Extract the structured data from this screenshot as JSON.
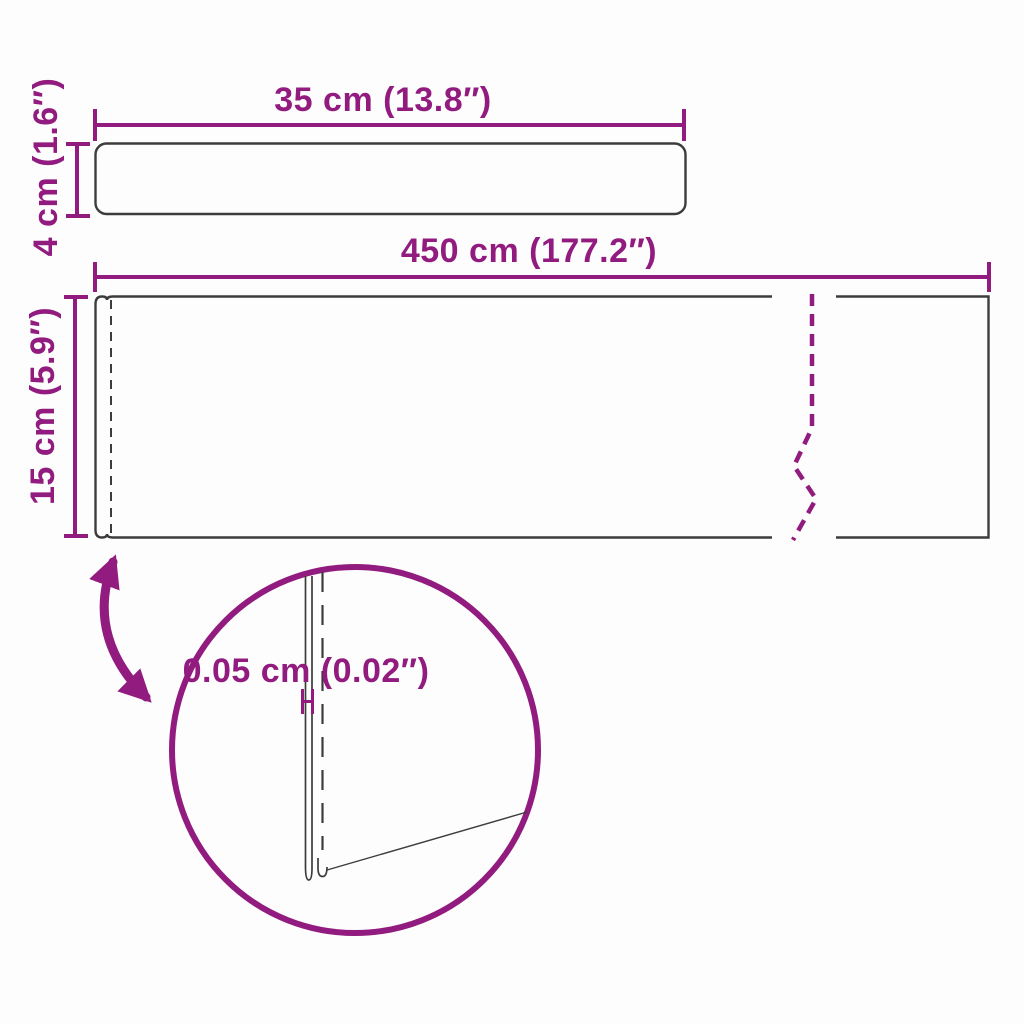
{
  "image_type": "product-dimension-diagram",
  "colors": {
    "accent": "#911B7E",
    "outline": "#3C3C3C",
    "background": "#FDFDFD"
  },
  "panels": {
    "small": {
      "width_label": "35 cm (13.8″)",
      "height_label": "4 cm (1.6″)"
    },
    "large": {
      "width_label": "450 cm (177.2″)",
      "height_label": "15 cm (5.9″)"
    }
  },
  "detail_view": {
    "thickness_label": "0.05 cm (0.02″)"
  }
}
